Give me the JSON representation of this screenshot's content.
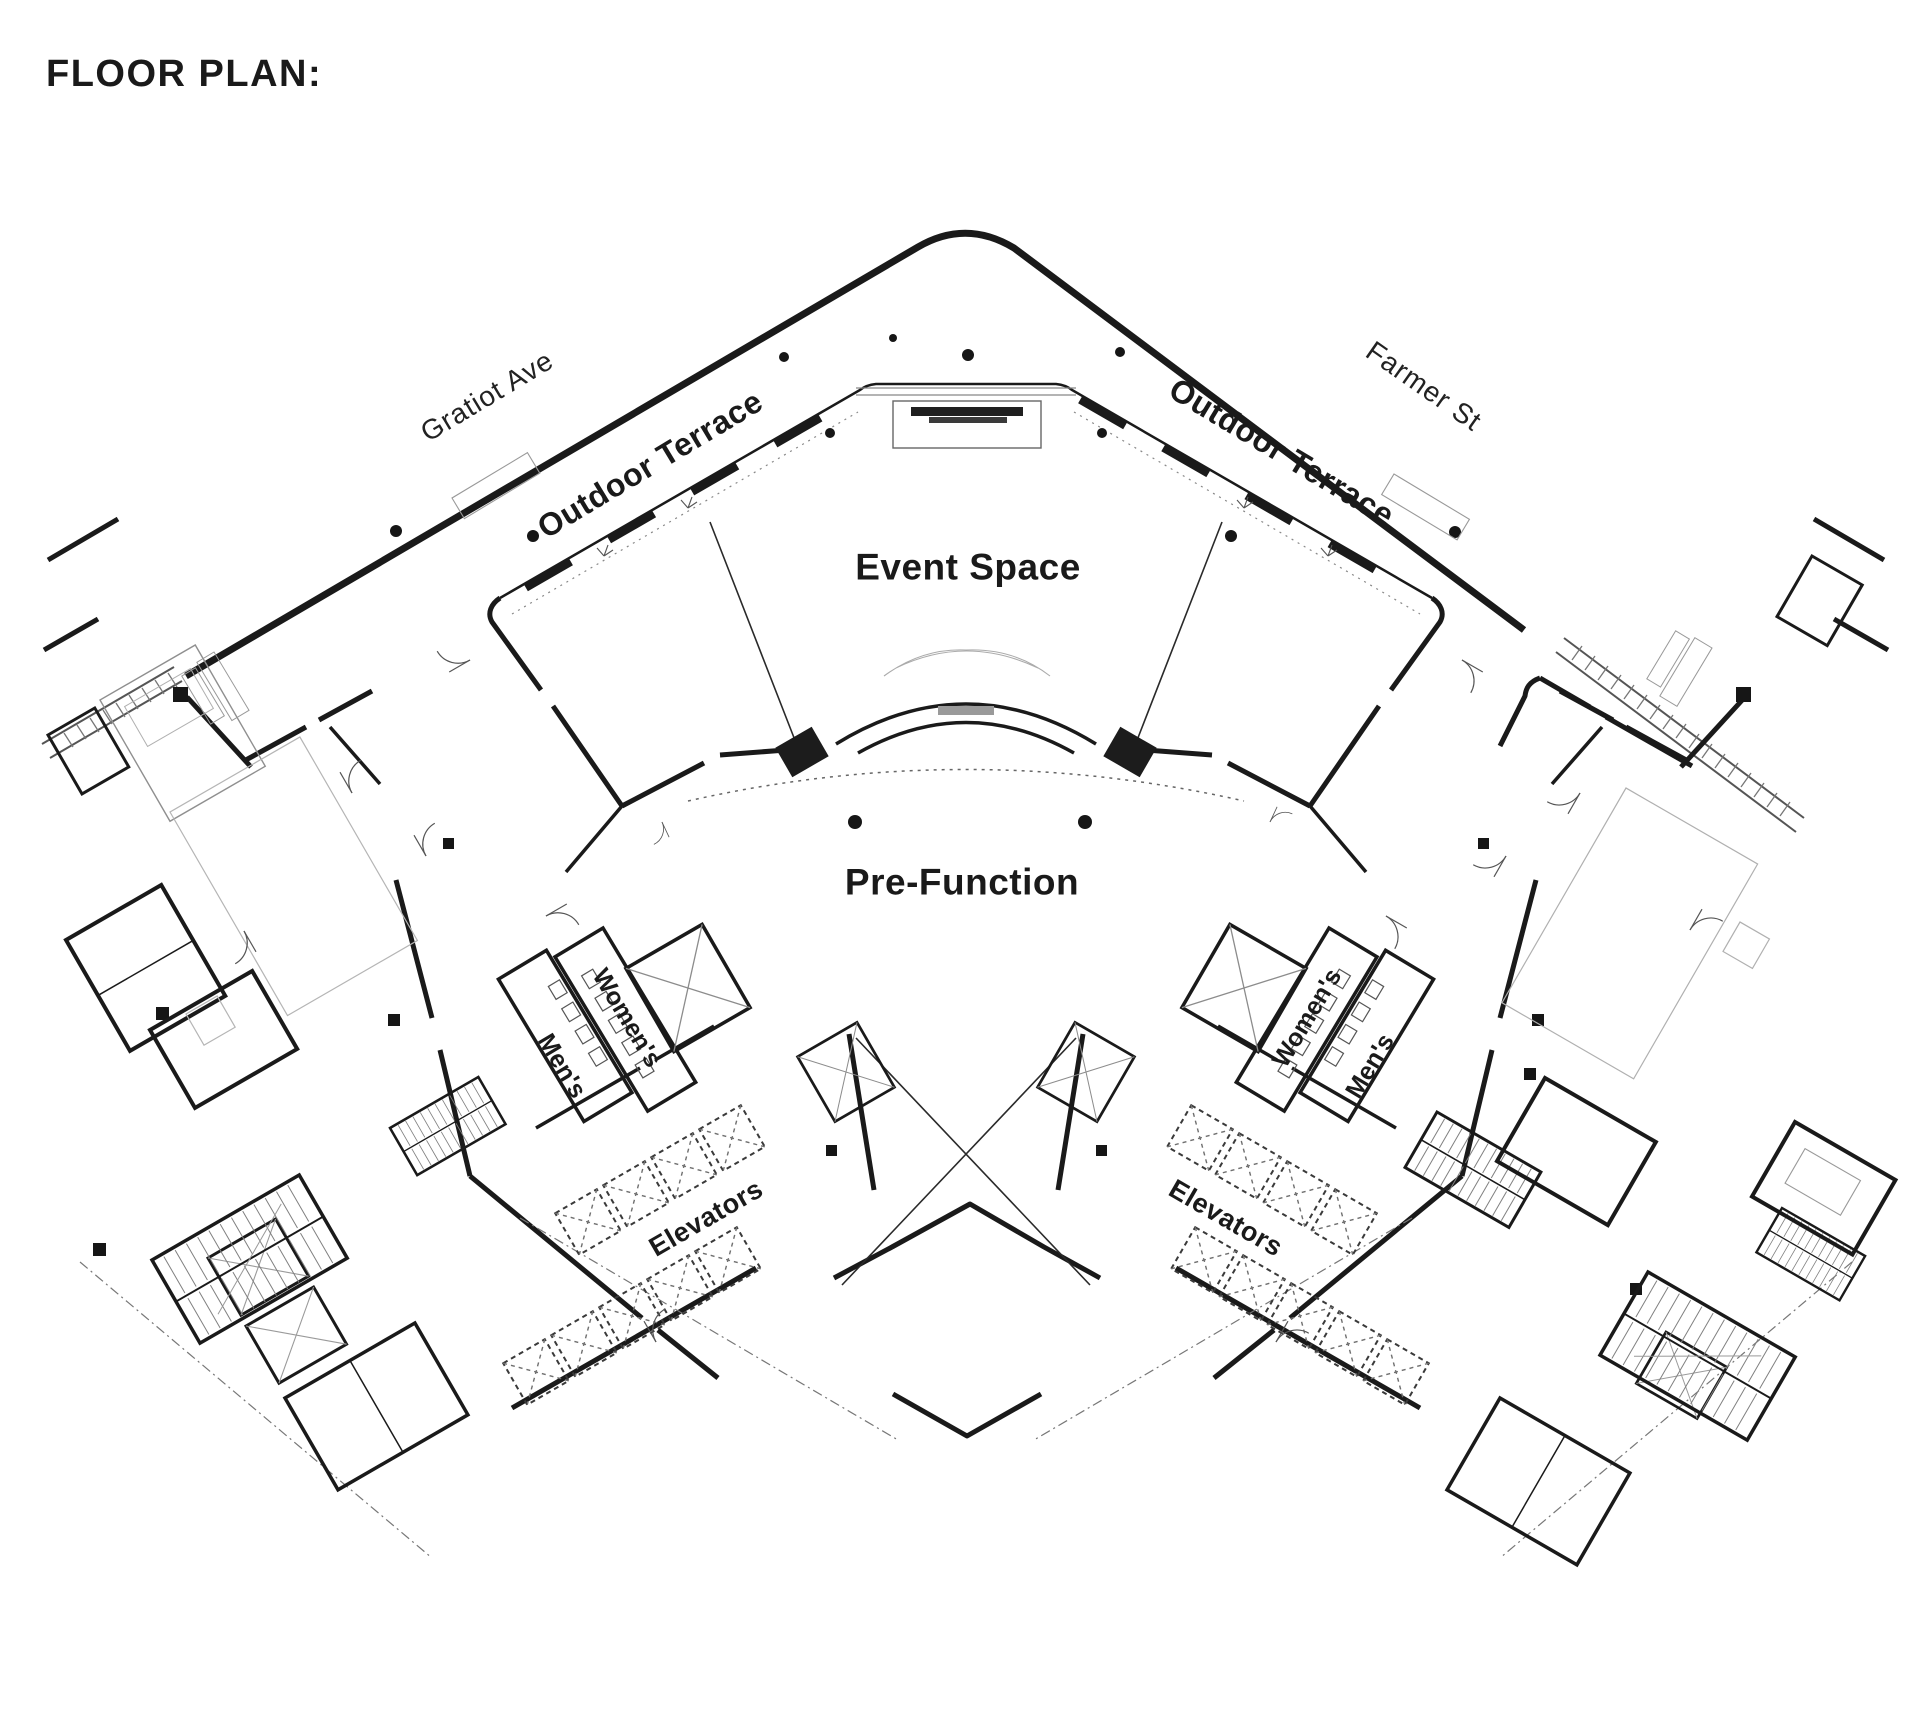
{
  "title": "FLOOR PLAN:",
  "streets": {
    "left": "Gratiot Ave",
    "right": "Farmer St"
  },
  "rooms": {
    "terrace_left": "Outdoor Terrace",
    "terrace_right": "Outdoor Terrace",
    "event_space": "Event Space",
    "pre_function": "Pre-Function",
    "womens_left": "Women's",
    "mens_left": "Men's",
    "womens_right": "Women's",
    "mens_right": "Men's",
    "elevators_left": "Elevators",
    "elevators_right": "Elevators"
  },
  "colors": {
    "ink": "#1a1a1a",
    "gray": "#8a8a8a",
    "light": "#b9b9b9",
    "paper": "#ffffff"
  }
}
